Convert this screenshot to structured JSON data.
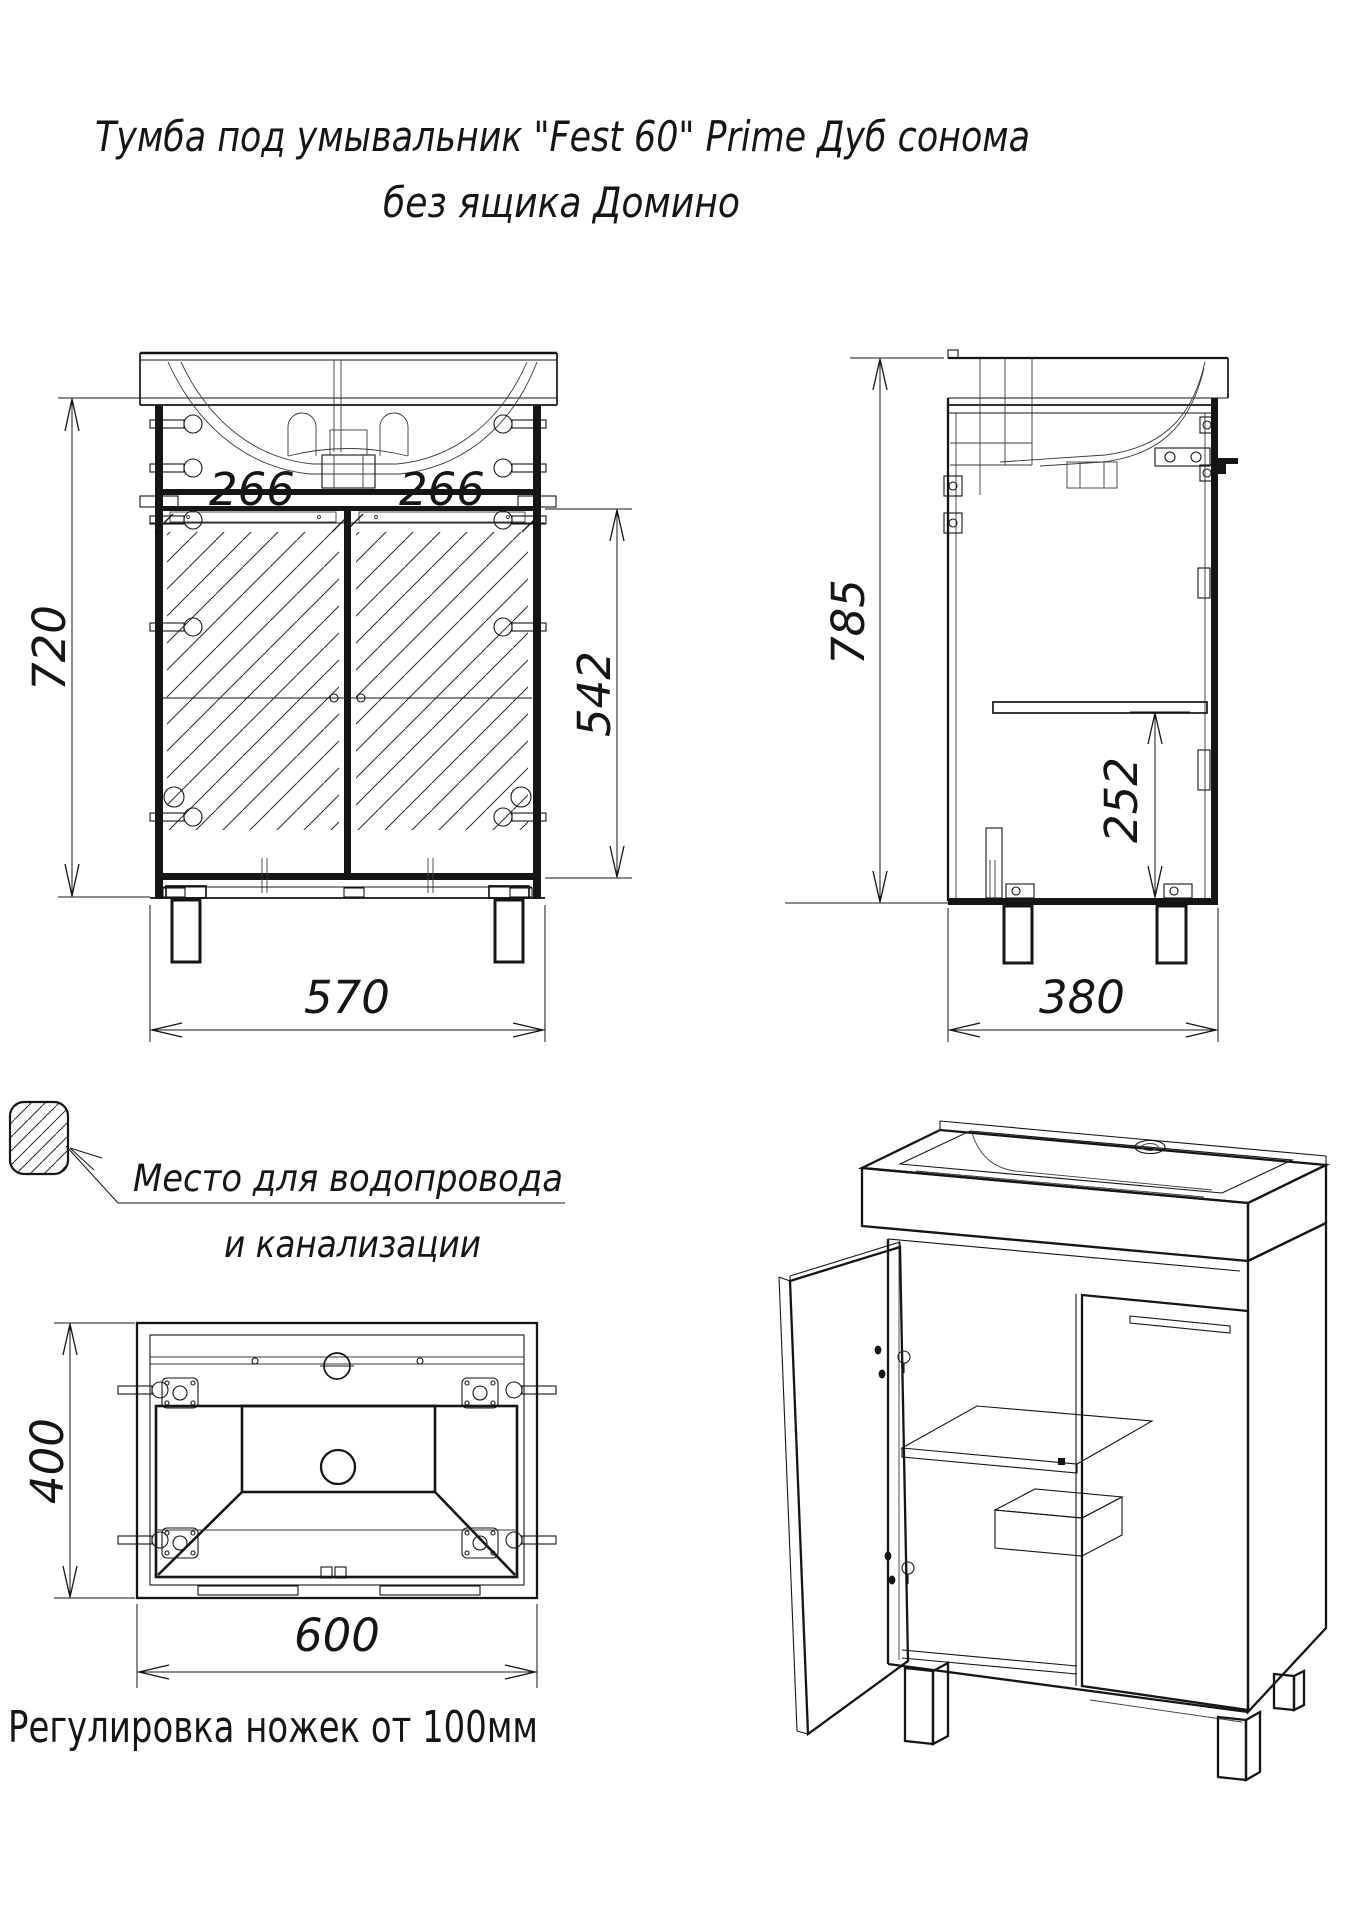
{
  "title": {
    "line1": "Тумба под умывальник \"Fest 60\" Prime Дуб сонома",
    "line2": "без ящика Домино"
  },
  "front_view": {
    "dim_height": "720",
    "dim_door_left": "266",
    "dim_door_right": "266",
    "dim_opening_height": "542",
    "dim_leg_span": "570"
  },
  "side_view": {
    "dim_height": "785",
    "dim_shelf_height": "252",
    "dim_depth": "380"
  },
  "bottom_view": {
    "dim_depth": "400",
    "dim_width": "600"
  },
  "plumbing_note": {
    "line1": "Место для водопровода",
    "line2": "и канализации"
  },
  "footer_note": "Регулировка ножек от 100мм",
  "colors": {
    "ink": "#151515",
    "paper": "#ffffff"
  }
}
